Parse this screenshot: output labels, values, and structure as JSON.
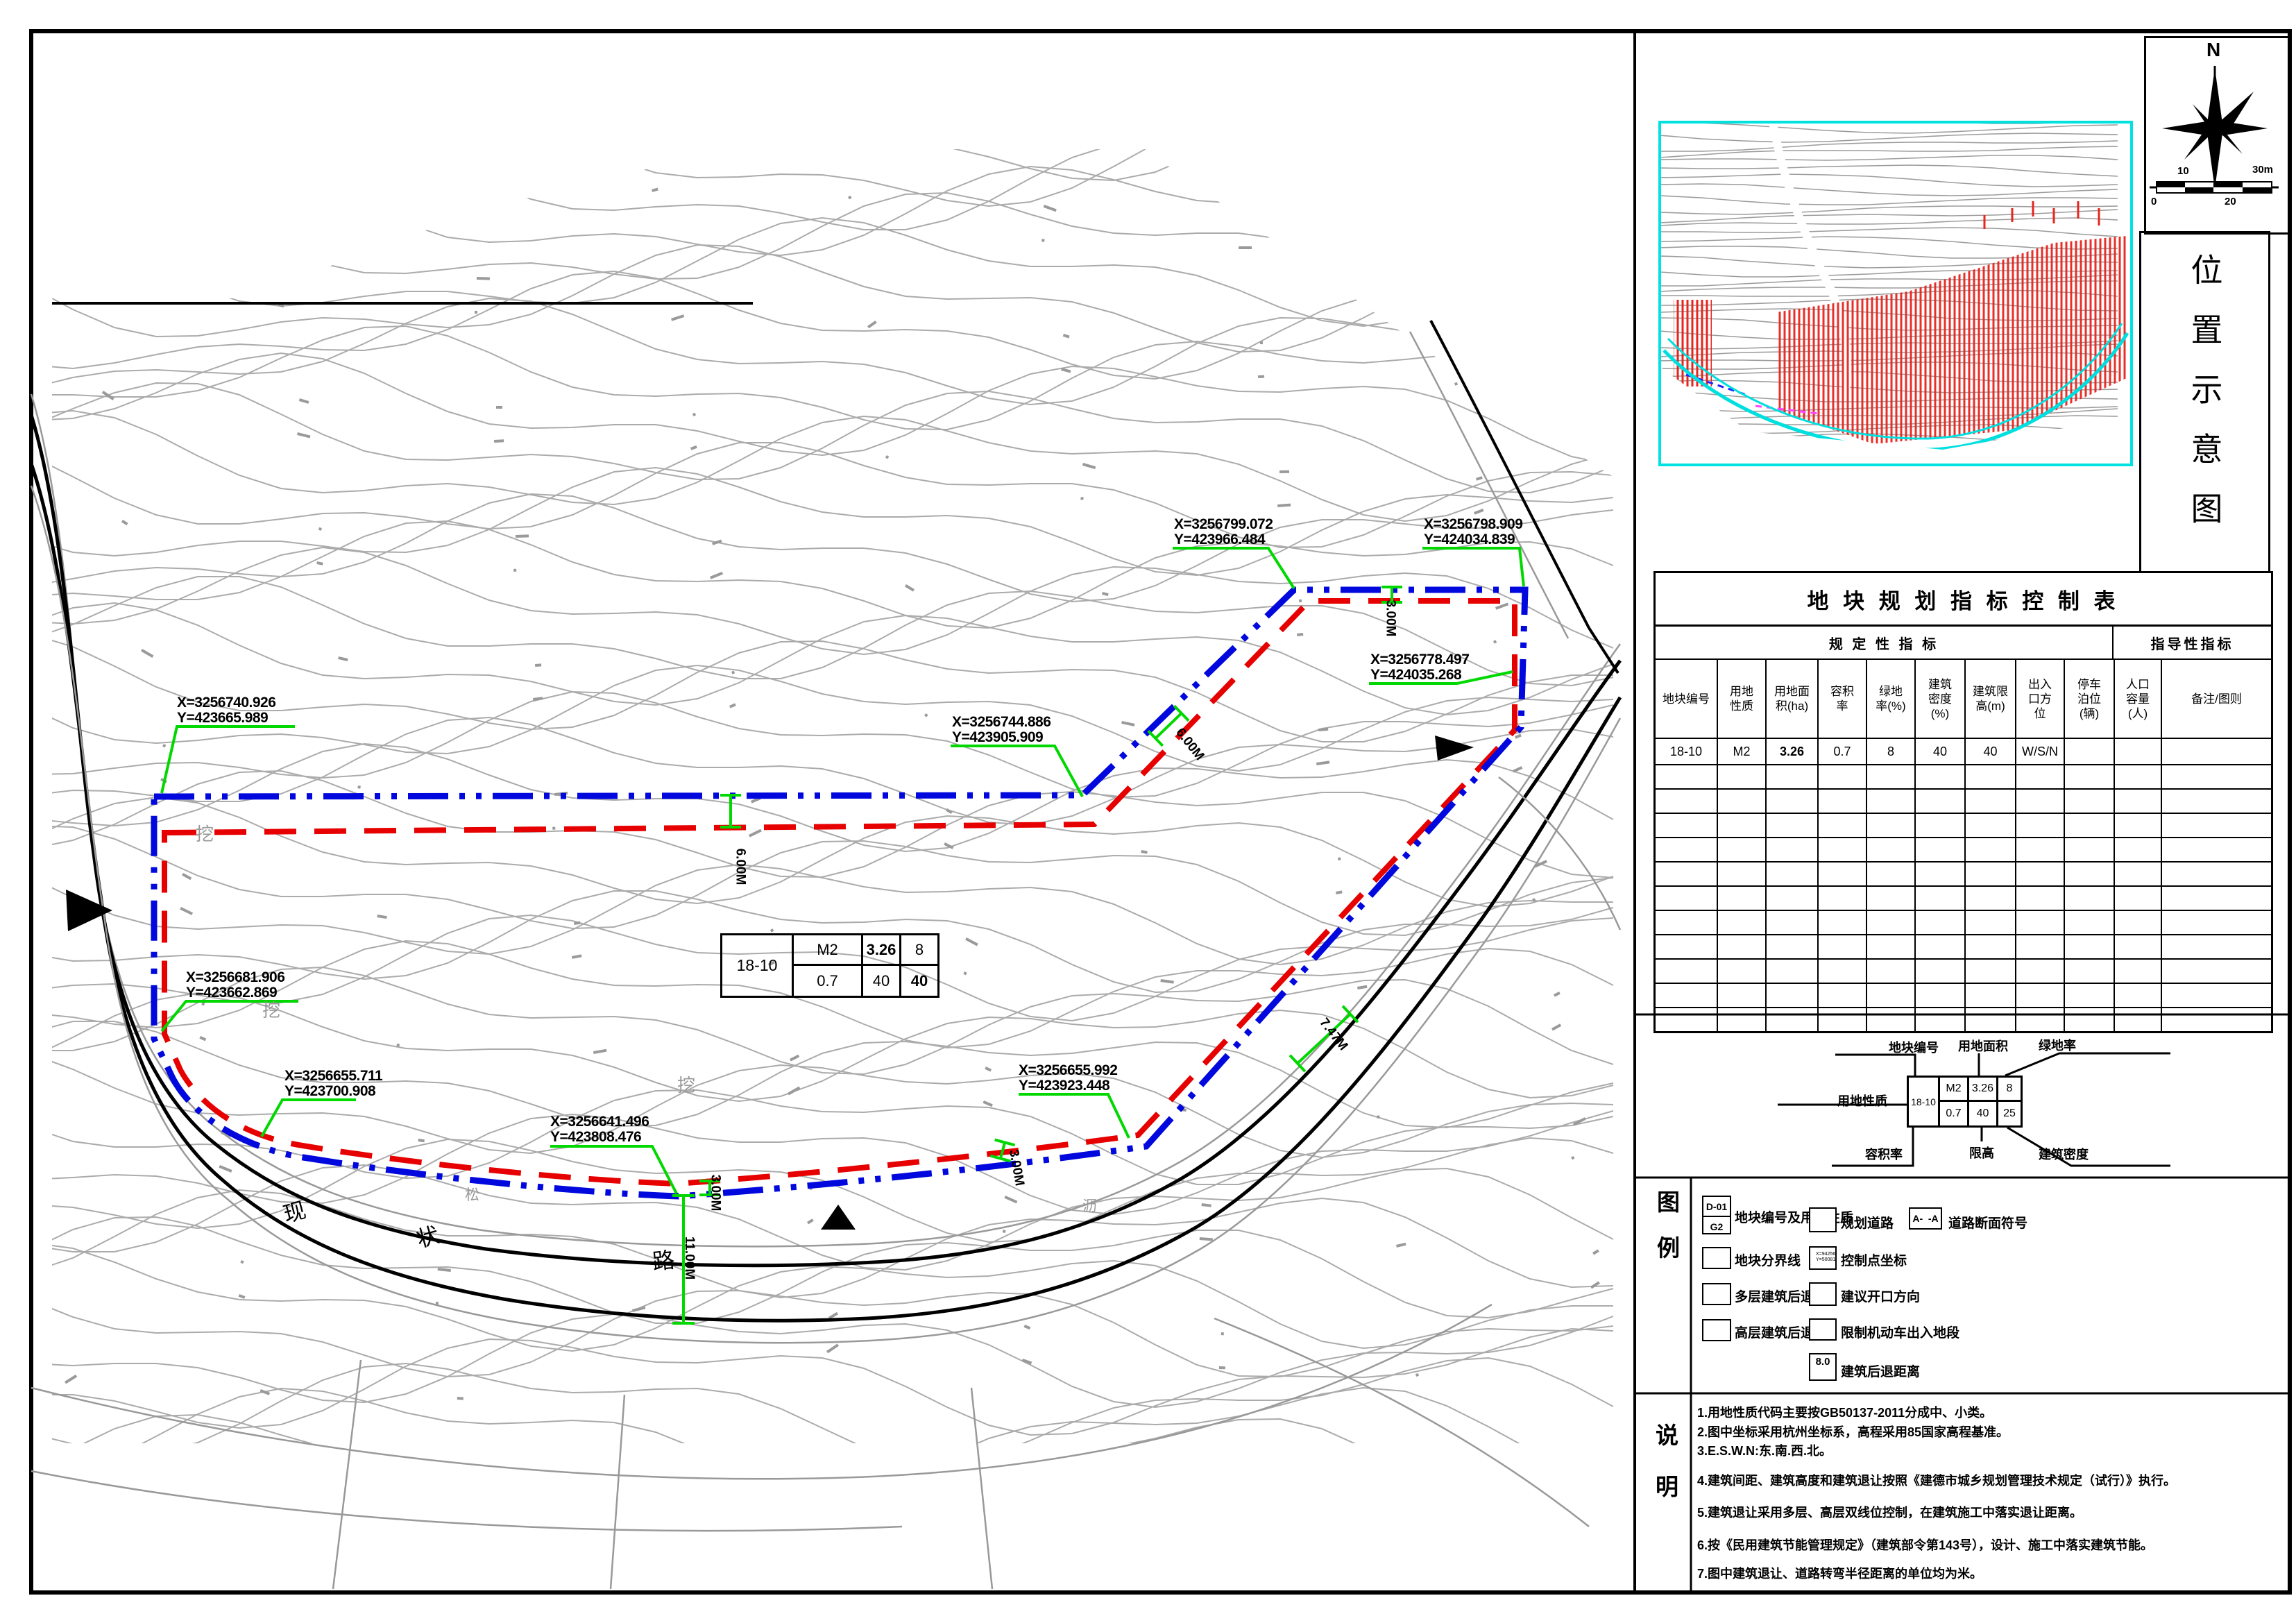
{
  "map": {
    "coordinate_labels": [
      {
        "x": "X=3256740.926",
        "y": "Y=423665.989"
      },
      {
        "x": "X=3256681.906",
        "y": "Y=423662.869"
      },
      {
        "x": "X=3256655.711",
        "y": "Y=423700.908"
      },
      {
        "x": "X=3256641.496",
        "y": "Y=423808.476"
      },
      {
        "x": "X=3256655.992",
        "y": "Y=423923.448"
      },
      {
        "x": "X=3256744.886",
        "y": "Y=423905.909"
      },
      {
        "x": "X=3256799.072",
        "y": "Y=423966.484"
      },
      {
        "x": "X=3256798.909",
        "y": "Y=424034.839"
      },
      {
        "x": "X=3256778.497",
        "y": "Y=424035.268"
      }
    ],
    "dimensions": {
      "d1": "6.00M",
      "d2": "6.00M",
      "d3": "3.00M",
      "d4": "3.00M",
      "d5": "3.00M",
      "d6": "11.00M",
      "d7": "7.47M"
    },
    "road_name": {
      "c1": "现",
      "c2": "状",
      "c3": "路"
    },
    "ground_marks": {
      "dig1": "挖",
      "dig2": "挖",
      "dig3": "挖",
      "m1": "松",
      "m2": "沥"
    },
    "plot_tag": {
      "id": "18-10",
      "use": "M2",
      "area": "3.26",
      "green": "8",
      "far": "0.7",
      "density": "40",
      "height": "40"
    }
  },
  "location_panel": {
    "title": "位置示意图",
    "compass": "N",
    "scale": {
      "top_left": "10",
      "top_right": "30m",
      "bottom_left": "0",
      "bottom_right": "20"
    }
  },
  "index_table": {
    "title": "地 块 规 划 指 标 控 制 表",
    "group_left": "规 定 性 指 标",
    "group_right": "指导性指标",
    "columns": [
      "地块编号",
      "用地性质",
      "用地面积(ha)",
      "容积率",
      "绿地率(%)",
      "建筑密度(%)",
      "建筑限高(m)",
      "出入口方位",
      "停车泊位(辆)",
      "人口容量(人)",
      "备注/图则"
    ],
    "row": {
      "c1": "18-10",
      "c2": "M2",
      "c3": "3.26",
      "c4": "0.7",
      "c5": "8",
      "c6": "40",
      "c7": "40",
      "c8": "W/S/N",
      "c9": "",
      "c10": "",
      "c11": ""
    }
  },
  "indicator_diagram": {
    "label_plot_no": "地块编号",
    "label_area": "用地面积",
    "label_green": "绿地率",
    "label_use": "用地性质",
    "label_far": "容积率",
    "label_height": "限高",
    "label_density": "建筑密度",
    "id": "18-10",
    "use": "M2",
    "area": "3.26",
    "green": "8",
    "far": "0.7",
    "height": "40",
    "density": "25"
  },
  "legend": {
    "label_c1": "图",
    "label_c2": "例",
    "plot_id_top": "D-01",
    "plot_id_bottom": "G2",
    "item_plot_id": "地块编号及用地性质",
    "item_boundary": "地块分界线",
    "item_multi_setback": "多层建筑后退",
    "item_high_setback": "高层建筑后退",
    "item_planned_road": "规划道路",
    "item_control_point": "控制点坐标",
    "control_x": "X=94256.336",
    "control_y": "Y=500818.789",
    "item_opening": "建议开口方向",
    "item_restricted": "限制机动车出入地段",
    "item_setback_dist": "建筑后退距离",
    "setback_val": "8.0",
    "item_section": "道路断面符号",
    "section_symbol": "A-  -A"
  },
  "notes": {
    "label_c1": "说",
    "label_c2": "明",
    "items": [
      "1.用地性质代码主要按GB50137-2011分成中、小类。",
      "2.图中坐标采用杭州坐标系，高程采用85国家高程基准。",
      "3.E.S.W.N:东.南.西.北。",
      "4.建筑间距、建筑高度和建筑退让按照《建德市城乡规划管理技术规定（试行）》执行。",
      "5.建筑退让采用多层、高层双线位控制，在建筑施工中落实退让距离。",
      "6.按《民用建筑节能管理规定》（建筑部令第143号），设计、施工中落实建筑节能。",
      "7.图中建筑退让、道路转弯半径距离的单位均为米。"
    ]
  }
}
